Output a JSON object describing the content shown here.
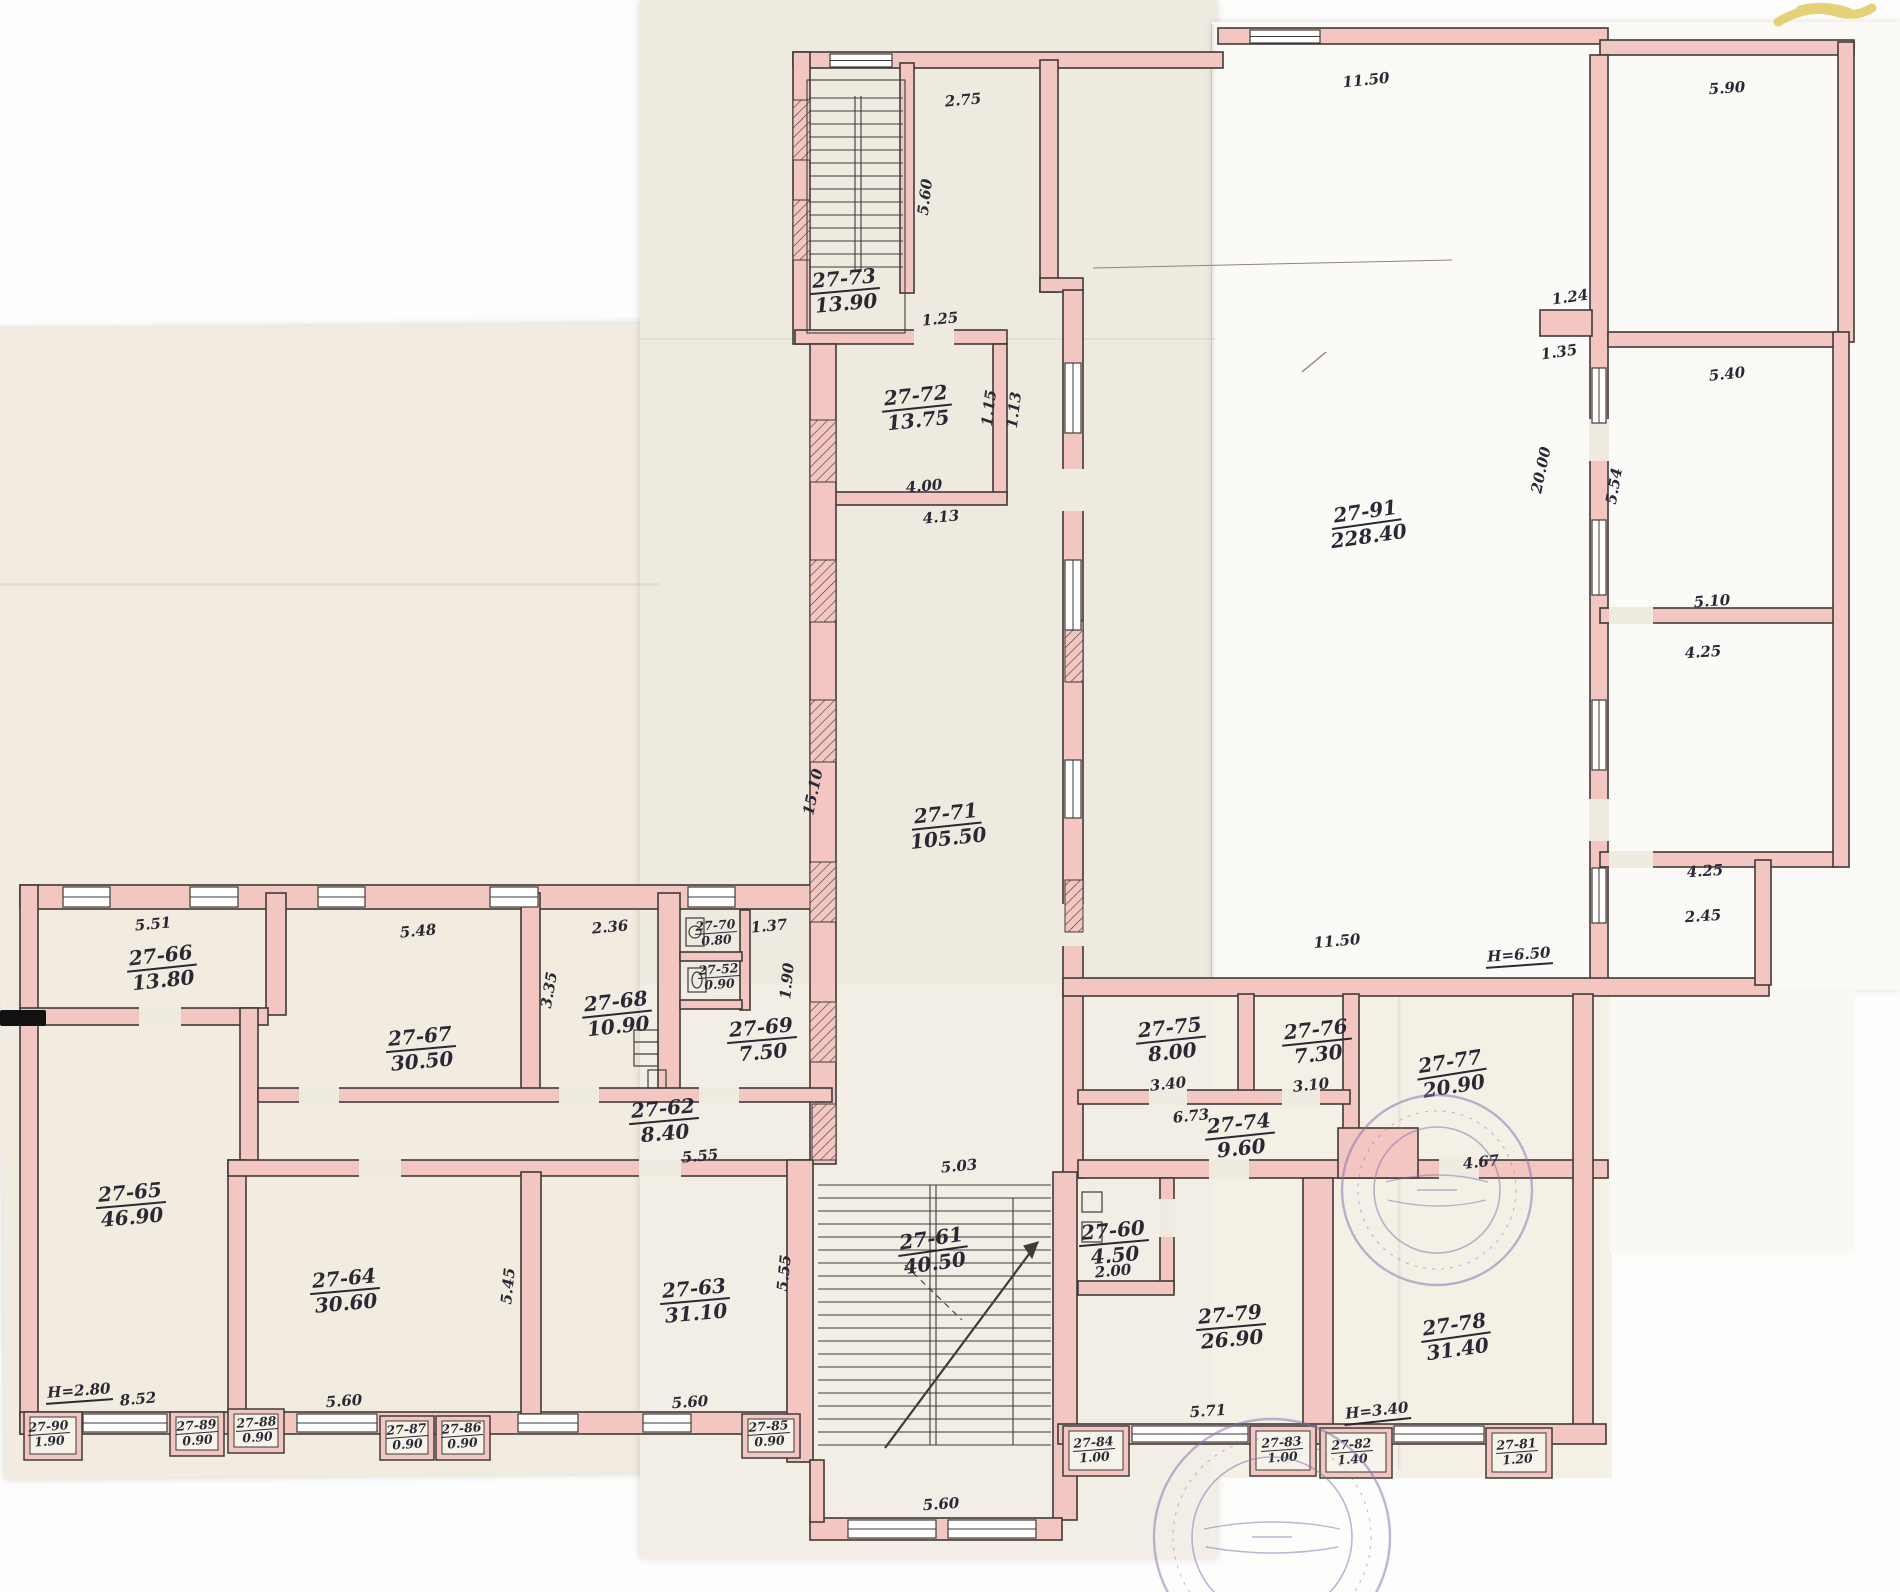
{
  "drawing": {
    "kind": "hand-drawn building floor plan (scanned sheets taped together)",
    "wall_color": "#f3c6c2",
    "ink_color": "#2b2836",
    "stamp_color": "#7f6fae",
    "highlight_color": "#dcc44d"
  },
  "rooms": [
    {
      "number": "27-73",
      "area": "13.90",
      "x": 845,
      "y": 291,
      "rot": -5,
      "size": "big"
    },
    {
      "number": "27-72",
      "area": "13.75",
      "x": 917,
      "y": 408,
      "rot": -6,
      "size": "big"
    },
    {
      "number": "27-91",
      "area": "228.40",
      "x": 1367,
      "y": 524,
      "rot": -8,
      "size": "big"
    },
    {
      "number": "27-71",
      "area": "105.50",
      "x": 947,
      "y": 826,
      "rot": -6,
      "size": "big"
    },
    {
      "number": "27-66",
      "area": "13.80",
      "x": 162,
      "y": 968,
      "rot": -6,
      "size": "big"
    },
    {
      "number": "27-67",
      "area": "30.50",
      "x": 421,
      "y": 1049,
      "rot": -5,
      "size": "big"
    },
    {
      "number": "27-68",
      "area": "10.90",
      "x": 617,
      "y": 1014,
      "rot": -6,
      "size": "big"
    },
    {
      "number": "27-70",
      "area": "0.80",
      "x": 716,
      "y": 933,
      "rot": -4,
      "size": "small"
    },
    {
      "number": "27-52",
      "area": "0.90",
      "x": 719,
      "y": 977,
      "rot": -4,
      "size": "small"
    },
    {
      "number": "27-69",
      "area": "7.50",
      "x": 762,
      "y": 1040,
      "rot": -5,
      "size": "big"
    },
    {
      "number": "27-62",
      "area": "8.40",
      "x": 664,
      "y": 1121,
      "rot": -5,
      "size": "big"
    },
    {
      "number": "27-65",
      "area": "46.90",
      "x": 131,
      "y": 1205,
      "rot": -5,
      "size": "big"
    },
    {
      "number": "27-64",
      "area": "30.60",
      "x": 345,
      "y": 1291,
      "rot": -5,
      "size": "big"
    },
    {
      "number": "27-63",
      "area": "31.10",
      "x": 695,
      "y": 1301,
      "rot": -5,
      "size": "big"
    },
    {
      "number": "27-61",
      "area": "40.50",
      "x": 933,
      "y": 1251,
      "rot": -8,
      "size": "big"
    },
    {
      "number": "27-60",
      "area": "4.50",
      "x": 1114,
      "y": 1243,
      "rot": -5,
      "size": "big"
    },
    {
      "number": "27-75",
      "area": "8.00",
      "x": 1171,
      "y": 1040,
      "rot": -6,
      "size": "big"
    },
    {
      "number": "27-76",
      "area": "7.30",
      "x": 1317,
      "y": 1042,
      "rot": -6,
      "size": "big"
    },
    {
      "number": "27-74",
      "area": "9.60",
      "x": 1240,
      "y": 1136,
      "rot": -6,
      "size": "big"
    },
    {
      "number": "27-77",
      "area": "20.90",
      "x": 1452,
      "y": 1074,
      "rot": -9,
      "size": "big"
    },
    {
      "number": "27-79",
      "area": "26.90",
      "x": 1231,
      "y": 1327,
      "rot": -5,
      "size": "big"
    },
    {
      "number": "27-78",
      "area": "31.40",
      "x": 1456,
      "y": 1337,
      "rot": -8,
      "size": "big"
    },
    {
      "number": "27-90",
      "area": "1.90",
      "x": 49,
      "y": 1434,
      "rot": -4,
      "size": "small"
    },
    {
      "number": "27-89",
      "area": "0.90",
      "x": 197,
      "y": 1433,
      "rot": -4,
      "size": "small"
    },
    {
      "number": "27-88",
      "area": "0.90",
      "x": 257,
      "y": 1430,
      "rot": -4,
      "size": "small"
    },
    {
      "number": "27-87",
      "area": "0.90",
      "x": 407,
      "y": 1437,
      "rot": -4,
      "size": "small"
    },
    {
      "number": "27-86",
      "area": "0.90",
      "x": 462,
      "y": 1436,
      "rot": -4,
      "size": "small"
    },
    {
      "number": "27-85",
      "area": "0.90",
      "x": 769,
      "y": 1434,
      "rot": -4,
      "size": "small"
    },
    {
      "number": "27-84",
      "area": "1.00",
      "x": 1094,
      "y": 1450,
      "rot": -4,
      "size": "small"
    },
    {
      "number": "27-83",
      "area": "1.00",
      "x": 1282,
      "y": 1450,
      "rot": -4,
      "size": "small"
    },
    {
      "number": "27-82",
      "area": "1.40",
      "x": 1352,
      "y": 1452,
      "rot": -4,
      "size": "small"
    },
    {
      "number": "27-81",
      "area": "1.20",
      "x": 1517,
      "y": 1452,
      "rot": -4,
      "size": "small"
    }
  ],
  "dims": [
    {
      "text": "2.75",
      "x": 963,
      "y": 100,
      "rot": -5
    },
    {
      "text": "5.60",
      "x": 925,
      "y": 197,
      "rot": -83
    },
    {
      "text": "1.25",
      "x": 940,
      "y": 319,
      "rot": -5
    },
    {
      "text": "11.50",
      "x": 1366,
      "y": 80,
      "rot": -6
    },
    {
      "text": "5.90",
      "x": 1727,
      "y": 88,
      "rot": -4
    },
    {
      "text": "1.24",
      "x": 1570,
      "y": 297,
      "rot": -8
    },
    {
      "text": "1.35",
      "x": 1559,
      "y": 352,
      "rot": -8
    },
    {
      "text": "20.00",
      "x": 1541,
      "y": 470,
      "rot": -78
    },
    {
      "text": "5.54",
      "x": 1614,
      "y": 486,
      "rot": -80
    },
    {
      "text": "5.40",
      "x": 1727,
      "y": 374,
      "rot": -6
    },
    {
      "text": "5.10",
      "x": 1712,
      "y": 601,
      "rot": -4
    },
    {
      "text": "4.25",
      "x": 1703,
      "y": 652,
      "rot": -4
    },
    {
      "text": "4.25",
      "x": 1705,
      "y": 871,
      "rot": -4
    },
    {
      "text": "2.45",
      "x": 1703,
      "y": 916,
      "rot": -4
    },
    {
      "text": "4.00",
      "x": 924,
      "y": 486,
      "rot": -5
    },
    {
      "text": "4.13",
      "x": 941,
      "y": 517,
      "rot": -5
    },
    {
      "text": "1.15",
      "x": 989,
      "y": 408,
      "rot": -83
    },
    {
      "text": "1.13",
      "x": 1014,
      "y": 410,
      "rot": -83
    },
    {
      "text": "15.10",
      "x": 813,
      "y": 792,
      "rot": -78
    },
    {
      "text": "11.50",
      "x": 1337,
      "y": 941,
      "rot": -5
    },
    {
      "text": "Н=6.50",
      "x": 1519,
      "y": 956,
      "rot": -4,
      "underline": true
    },
    {
      "text": "5.51",
      "x": 153,
      "y": 924,
      "rot": -5
    },
    {
      "text": "5.48",
      "x": 418,
      "y": 931,
      "rot": -5
    },
    {
      "text": "2.36",
      "x": 610,
      "y": 927,
      "rot": -5
    },
    {
      "text": "3.35",
      "x": 549,
      "y": 990,
      "rot": -80
    },
    {
      "text": "1.37",
      "x": 769,
      "y": 926,
      "rot": -5
    },
    {
      "text": "1.90",
      "x": 787,
      "y": 981,
      "rot": -84
    },
    {
      "text": "5.55",
      "x": 700,
      "y": 1156,
      "rot": -5
    },
    {
      "text": "5.45",
      "x": 508,
      "y": 1286,
      "rot": -84
    },
    {
      "text": "5.55",
      "x": 784,
      "y": 1273,
      "rot": -84
    },
    {
      "text": "Н=2.80",
      "x": 79,
      "y": 1392,
      "rot": -4,
      "underline": true
    },
    {
      "text": "8.52",
      "x": 138,
      "y": 1399,
      "rot": -5
    },
    {
      "text": "5.60",
      "x": 344,
      "y": 1401,
      "rot": -4
    },
    {
      "text": "5.60",
      "x": 690,
      "y": 1402,
      "rot": -4
    },
    {
      "text": "5.60",
      "x": 941,
      "y": 1504,
      "rot": -4
    },
    {
      "text": "3.40",
      "x": 1168,
      "y": 1084,
      "rot": -6
    },
    {
      "text": "3.10",
      "x": 1311,
      "y": 1085,
      "rot": -6
    },
    {
      "text": "6.73",
      "x": 1191,
      "y": 1116,
      "rot": -6
    },
    {
      "text": "5.03",
      "x": 959,
      "y": 1166,
      "rot": -5
    },
    {
      "text": "2.00",
      "x": 1113,
      "y": 1271,
      "rot": -5
    },
    {
      "text": "4.67",
      "x": 1481,
      "y": 1162,
      "rot": -6
    },
    {
      "text": "5.71",
      "x": 1208,
      "y": 1411,
      "rot": -4
    },
    {
      "text": "Н=3.40",
      "x": 1377,
      "y": 1412,
      "rot": -6,
      "underline": true
    }
  ],
  "stamps": [
    {
      "x": 1437,
      "y": 1190,
      "r_outer": 95,
      "r_inner": 63
    },
    {
      "x": 1272,
      "y": 1537,
      "r_outer": 118,
      "r_inner": 80
    }
  ]
}
